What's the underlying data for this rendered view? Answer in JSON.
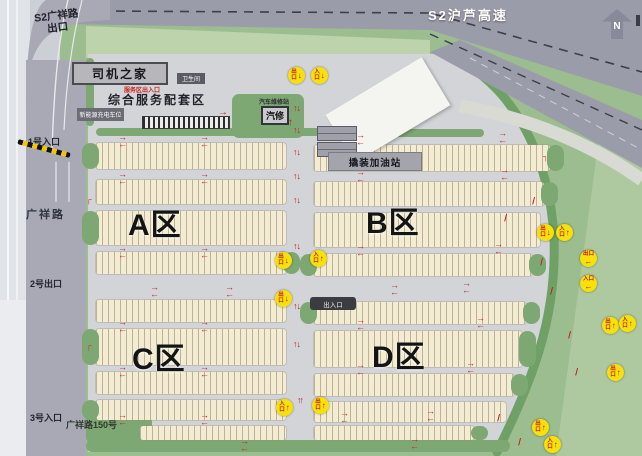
{
  "labels": {
    "highway": "S2沪芦高速",
    "ramp_exit": "S2广祥路\n出口",
    "entrance1": "1号入口",
    "road_name": "广祥路",
    "exit2": "2号出口",
    "entrance3": "3号入口",
    "address": "广祥路150号",
    "north": "N"
  },
  "service": {
    "driver_home": "司机之家",
    "note": "服务区出入口",
    "title": "综合服务配套区",
    "charging": "新能源充电车位",
    "restroom": "卫生间",
    "repair_station": "汽车维修站",
    "repair": "汽修",
    "gas": "撬装加油站",
    "gate": "出入口"
  },
  "zones": [
    {
      "label": "A区",
      "x": 128,
      "y": 200
    },
    {
      "label": "B区",
      "x": 366,
      "y": 198
    },
    {
      "label": "C区",
      "x": 132,
      "y": 334
    },
    {
      "label": "D区",
      "x": 372,
      "y": 332
    }
  ],
  "colors": {
    "badge_yellow": "#f6e10a",
    "badge_text_red": "#c41212",
    "arrow_red": "#c32222",
    "green_main": "#9cbd8f",
    "green_hedge": "#7ea873",
    "parking_cream": "#f3ecd2",
    "road_gray": "#a8a9b4",
    "facility_gray": "#d3d4d8"
  },
  "rows": [
    [
      96,
      143,
      190,
      26,
      "l"
    ],
    [
      314,
      145,
      236,
      26,
      "r"
    ],
    [
      96,
      180,
      190,
      24,
      ""
    ],
    [
      314,
      182,
      230,
      24,
      "r"
    ],
    [
      96,
      211,
      190,
      34,
      "l"
    ],
    [
      314,
      213,
      226,
      34,
      ""
    ],
    [
      96,
      252,
      190,
      22,
      "r"
    ],
    [
      314,
      254,
      218,
      22,
      "lr"
    ],
    [
      96,
      300,
      190,
      22,
      ""
    ],
    [
      314,
      302,
      212,
      22,
      "lr"
    ],
    [
      96,
      329,
      190,
      36,
      "l"
    ],
    [
      314,
      331,
      208,
      36,
      "r"
    ],
    [
      96,
      372,
      190,
      22,
      ""
    ],
    [
      314,
      374,
      200,
      22,
      "r"
    ],
    [
      96,
      400,
      190,
      20,
      "l"
    ],
    [
      314,
      402,
      192,
      20,
      ""
    ],
    [
      140,
      426,
      146,
      14,
      ""
    ],
    [
      314,
      426,
      160,
      14,
      "r"
    ]
  ],
  "hedges": [
    [
      96,
      128,
      292,
      8
    ],
    [
      316,
      129,
      168,
      8
    ],
    [
      86,
      58,
      8,
      68
    ],
    [
      232,
      94,
      72,
      44
    ],
    [
      86,
      440,
      424,
      12
    ],
    [
      86,
      404,
      66,
      40
    ]
  ],
  "badges": [
    [
      288,
      67,
      "出口",
      "↓"
    ],
    [
      311,
      67,
      "入口",
      "↓"
    ],
    [
      537,
      224,
      "出口",
      "↓"
    ],
    [
      556,
      224,
      "入口",
      "↑"
    ],
    [
      580,
      250,
      "出口",
      "←"
    ],
    [
      580,
      275,
      "入口",
      "←"
    ],
    [
      275,
      252,
      "出口",
      "↓"
    ],
    [
      310,
      250,
      "入口",
      "↑"
    ],
    [
      275,
      290,
      "出口",
      "↓"
    ],
    [
      602,
      317,
      "出口",
      "↑"
    ],
    [
      619,
      315,
      "入口",
      "↑"
    ],
    [
      607,
      364,
      "出口",
      "↑"
    ],
    [
      276,
      399,
      "入口",
      "↑"
    ],
    [
      312,
      397,
      "出口",
      "↑"
    ],
    [
      532,
      419,
      "出口",
      "↑"
    ],
    [
      544,
      436,
      "入口",
      "↑"
    ]
  ],
  "arrows": [
    [
      118,
      134,
      "he"
    ],
    [
      200,
      134,
      "he"
    ],
    [
      356,
      132,
      "he"
    ],
    [
      498,
      130,
      "he"
    ],
    [
      118,
      171,
      "he"
    ],
    [
      200,
      171,
      "he"
    ],
    [
      356,
      169,
      "he"
    ],
    [
      500,
      167,
      "he"
    ],
    [
      118,
      245,
      "he"
    ],
    [
      200,
      245,
      "he"
    ],
    [
      356,
      243,
      "he"
    ],
    [
      494,
      241,
      "he"
    ],
    [
      150,
      284,
      "he"
    ],
    [
      225,
      284,
      "he"
    ],
    [
      390,
      282,
      "he"
    ],
    [
      462,
      280,
      "he"
    ],
    [
      118,
      319,
      "he"
    ],
    [
      200,
      319,
      "he"
    ],
    [
      356,
      317,
      "he"
    ],
    [
      476,
      315,
      "he"
    ],
    [
      118,
      364,
      "he"
    ],
    [
      200,
      364,
      "he"
    ],
    [
      356,
      362,
      "he"
    ],
    [
      466,
      360,
      "he"
    ],
    [
      118,
      412,
      "he"
    ],
    [
      200,
      412,
      "he"
    ],
    [
      340,
      410,
      "he"
    ],
    [
      426,
      408,
      "he"
    ],
    [
      240,
      438,
      "he"
    ],
    [
      410,
      436,
      "he"
    ],
    [
      293,
      104,
      "v2"
    ],
    [
      293,
      126,
      "v2"
    ],
    [
      293,
      148,
      "v2"
    ],
    [
      293,
      172,
      "v2"
    ],
    [
      293,
      196,
      "v2"
    ],
    [
      293,
      242,
      "v2"
    ],
    [
      293,
      302,
      "v2"
    ],
    [
      293,
      340,
      "v2"
    ],
    [
      297,
      396,
      "vu"
    ],
    [
      533,
      196,
      "hash"
    ],
    [
      541,
      257,
      "hash"
    ],
    [
      551,
      286,
      "hash"
    ],
    [
      569,
      330,
      "hash"
    ],
    [
      576,
      367,
      "hash"
    ],
    [
      498,
      413,
      "hash"
    ],
    [
      519,
      437,
      "hash"
    ],
    [
      505,
      213,
      "hash"
    ],
    [
      218,
      108,
      "r"
    ],
    [
      288,
      118,
      "u"
    ],
    [
      86,
      196,
      "cr"
    ],
    [
      86,
      342,
      "cr"
    ],
    [
      543,
      153,
      "cj"
    ],
    [
      543,
      222,
      "cj"
    ]
  ]
}
